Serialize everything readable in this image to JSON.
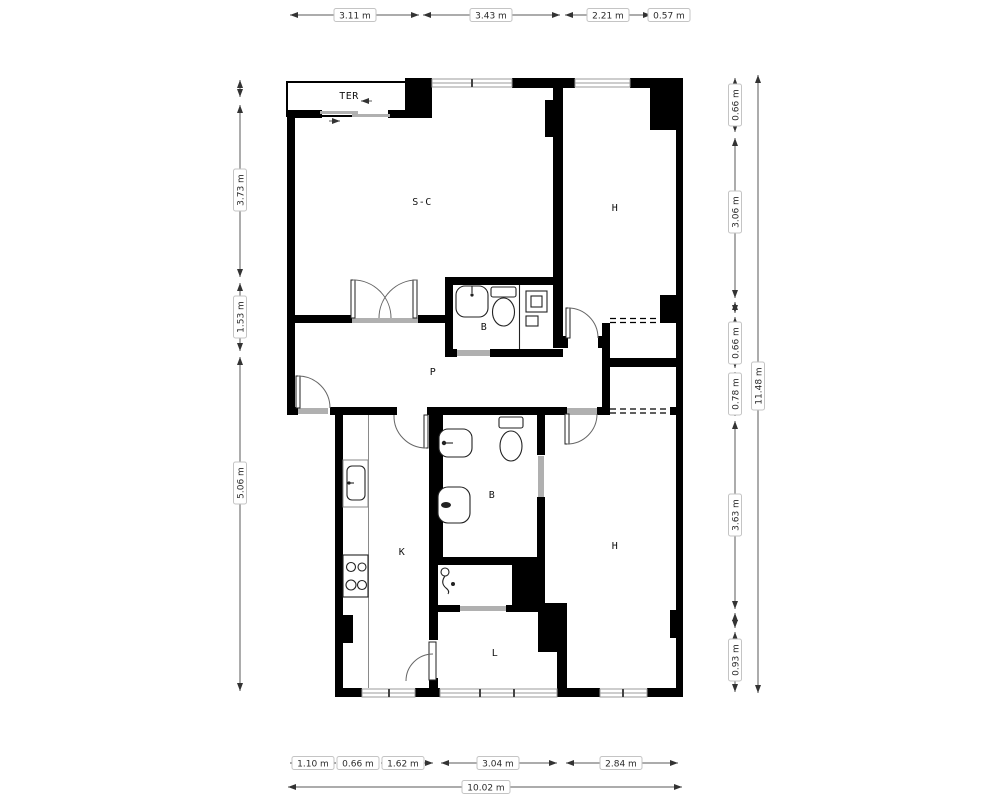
{
  "floorplan": {
    "type": "apartment-floor-plan",
    "rooms": [
      {
        "id": "terrace",
        "label": "TER"
      },
      {
        "id": "living-dining",
        "label": "S-C"
      },
      {
        "id": "bedroom-top",
        "label": "H"
      },
      {
        "id": "bathroom-top",
        "label": "B"
      },
      {
        "id": "hallway",
        "label": "P"
      },
      {
        "id": "kitchen",
        "label": "K"
      },
      {
        "id": "bathroom-bottom",
        "label": "B"
      },
      {
        "id": "bedroom-bottom",
        "label": "H"
      },
      {
        "id": "laundry",
        "label": "L"
      }
    ],
    "dimensions": {
      "top": [
        "3.11 m",
        "3.43 m",
        "2.21 m",
        "0.57 m"
      ],
      "left": [
        "3.73 m",
        "1.53 m",
        "5.06 m"
      ],
      "right": [
        "0.66 m",
        "3.06 m",
        "0.66 m",
        "0.78 m",
        "3.63 m",
        "0.93 m"
      ],
      "right_total": "11.48 m",
      "bottom": [
        "1.10 m",
        "0.66 m",
        "1.62 m",
        "3.04 m",
        "2.84 m"
      ],
      "bottom_total": "10.02 m"
    },
    "colors": {
      "wall": "#000000",
      "window": "#9b9b9b",
      "threshold": "#b0b0b0",
      "dimension_line": "#5a5a5a",
      "label_box_border": "#c4c4c4",
      "text": "#2b2b2b"
    }
  }
}
